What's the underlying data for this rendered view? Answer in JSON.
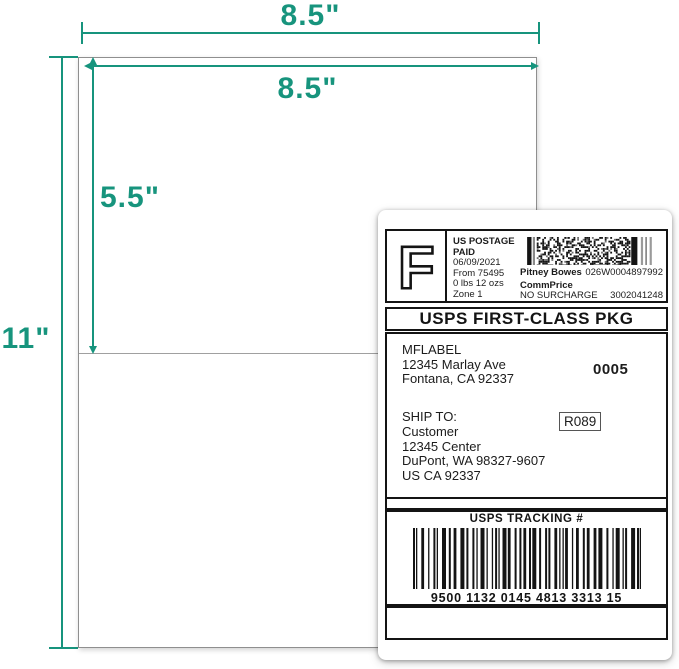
{
  "colors": {
    "accent": "#17947D",
    "ink": "#141414"
  },
  "dimensions": {
    "sheet_width": "8.5\"",
    "label_width": "8.5\"",
    "label_height": "5.5\"",
    "sheet_height": "11\""
  },
  "shipping_label": {
    "postage": {
      "logo_letter": "F",
      "lines": [
        "US POSTAGE",
        "PAID",
        "06/09/2021",
        "From 75495",
        "0 lbs 12 ozs",
        "Zone 1"
      ],
      "carrier": "Pitney Bowes",
      "meter_number": "026W0004897992",
      "rate_class": "CommPrice",
      "surcharge": "NO SURCHARGE",
      "account_number": "3002041248"
    },
    "service_banner": "USPS FIRST-CLASS PKG",
    "from": {
      "name": "MFLABEL",
      "street": "12345 Marlay Ave",
      "city_line": "Fontana, CA 92337"
    },
    "batch_number": "0005",
    "ship_to_label": "SHIP TO:",
    "to": {
      "name": "Customer",
      "street": "12345 Center",
      "city_line": "DuPont, WA 98327-9607",
      "country_line": "US CA 92337"
    },
    "route_code": "R089",
    "tracking": {
      "title": "USPS TRACKING #",
      "number": "9500 1132 0145 4813 3313 15"
    }
  }
}
